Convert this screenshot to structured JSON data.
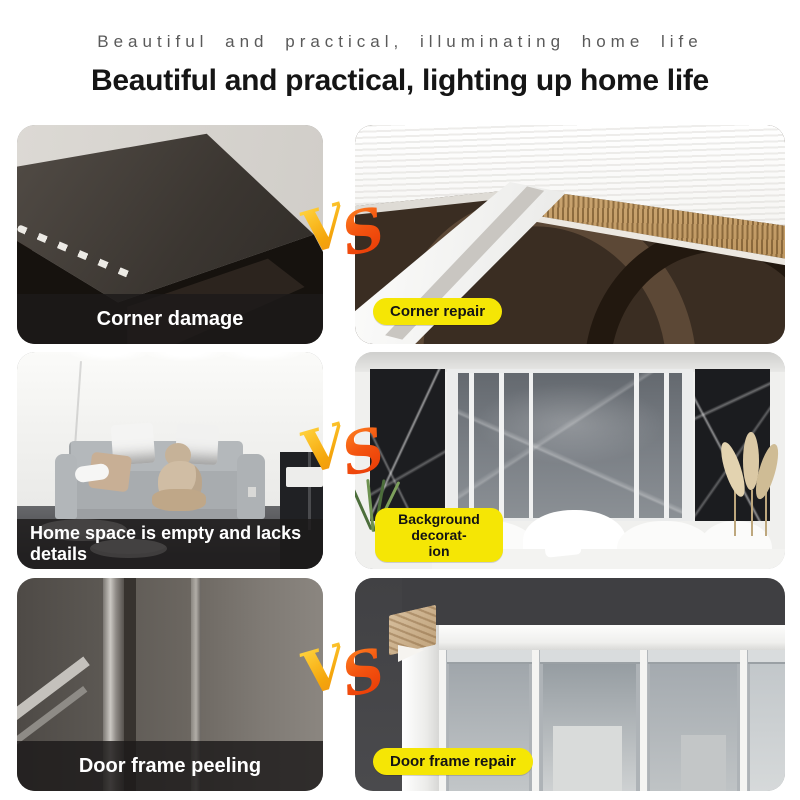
{
  "header": {
    "subtitle": "Beautiful and practical, illuminating home life",
    "title": "Beautiful and practical, lighting up home life"
  },
  "vs": {
    "v": "V",
    "s": "S"
  },
  "colors": {
    "tag_yellow": "#f5e605",
    "vs_yellow_gradient": [
      "#ffd23d",
      "#ef8d10"
    ],
    "vs_red_gradient": [
      "#ff8a24",
      "#e63404"
    ],
    "caption_bar": "rgba(28,26,26,0.82)",
    "caption_text": "#ffffff",
    "title_text": "#151515",
    "subtitle_text": "#5a5a5a",
    "background": "#ffffff"
  },
  "rows": [
    {
      "left_caption": "Corner damage",
      "tag_lines": [
        "Corner repair"
      ]
    },
    {
      "left_caption": "Home space is empty and lacks details",
      "tag_lines": [
        "Background decorat-",
        "ion"
      ]
    },
    {
      "left_caption": "Door frame peeling",
      "tag_lines": [
        "Door frame repair"
      ]
    }
  ]
}
